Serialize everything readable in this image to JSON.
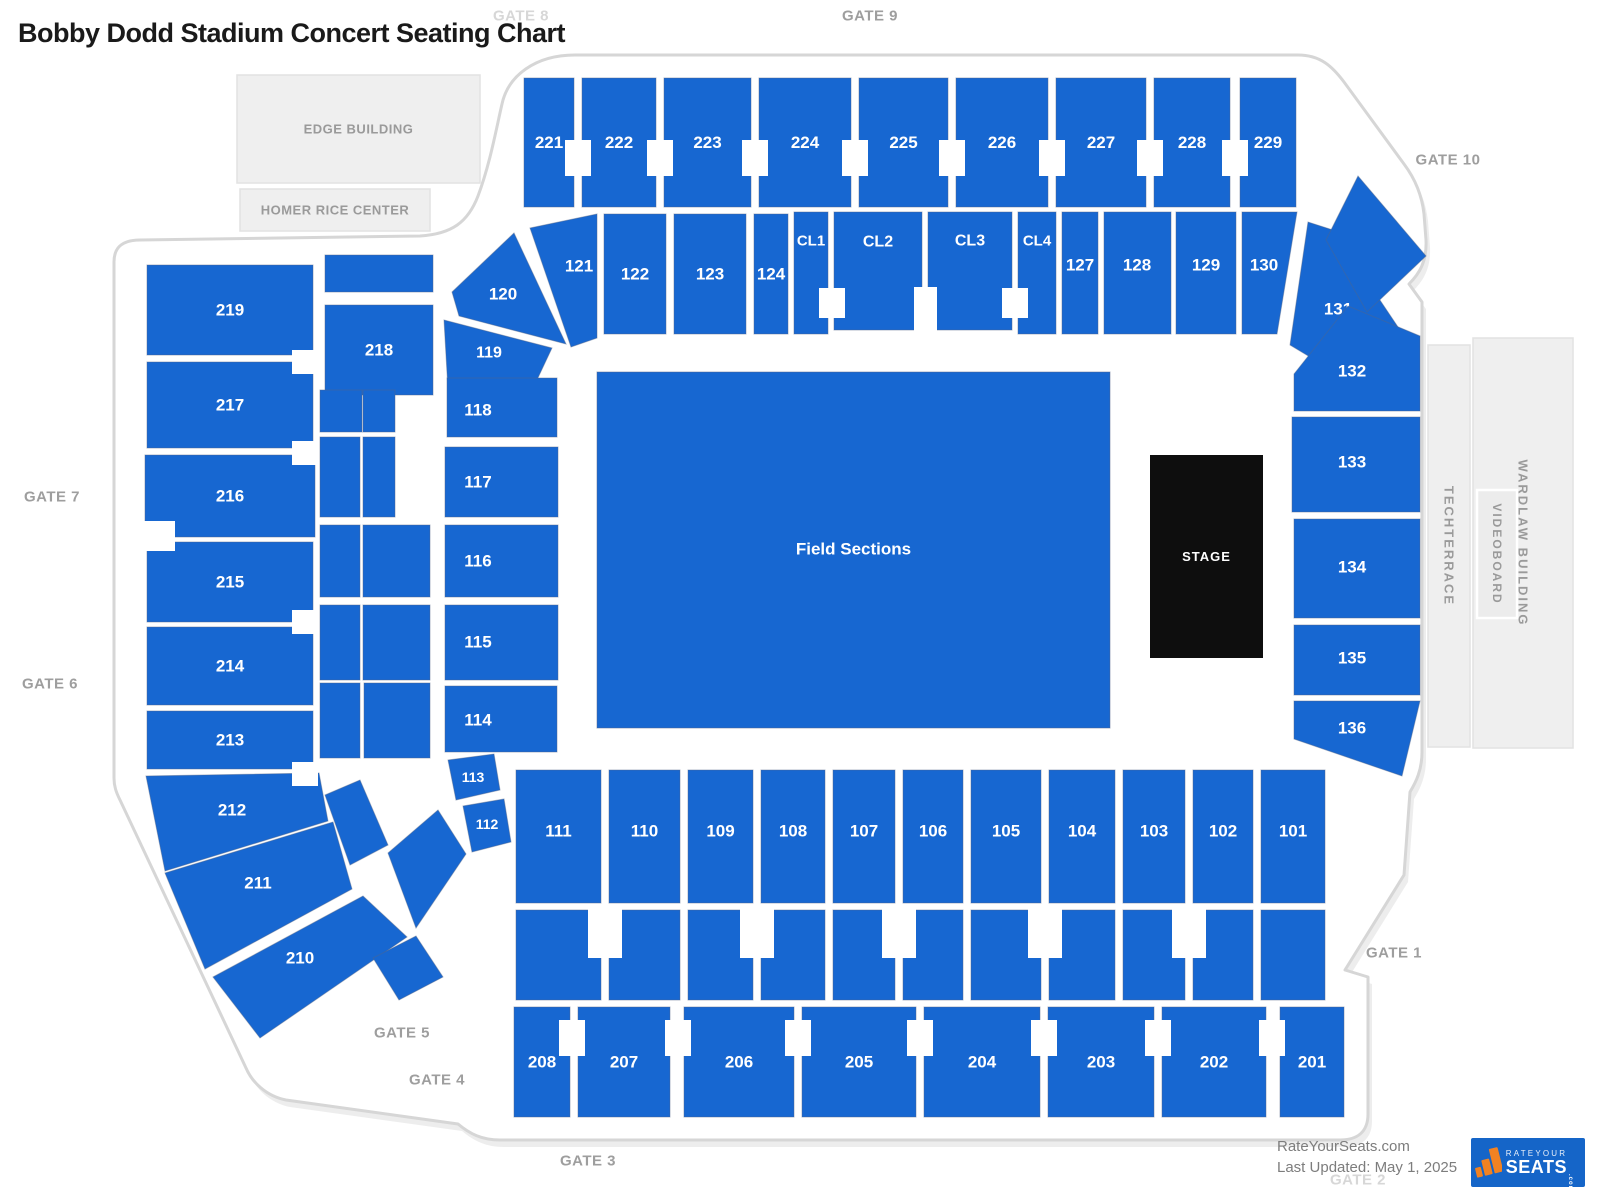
{
  "title": "Bobby Dodd Stadium Concert Seating Chart",
  "colors": {
    "section": "#1767D1",
    "section_stroke": "#51668A",
    "stage_bg": "#0E0E0E",
    "outline": "#D6D6D6",
    "building_fill": "#EFEFEF",
    "building_stroke": "#E2E2E2",
    "building_text": "#9A9A9A",
    "gate_text": "#9E9E9E",
    "gate_text_light": "#D7D7D7",
    "label_text": "#FFFFFF",
    "footer_text": "#7D7D7D",
    "logo_blue": "#1565C8",
    "logo_orange": "#F18222"
  },
  "gates": [
    {
      "id": "gate-8",
      "label": "GATE 8",
      "x": 521,
      "y": 16,
      "muted": true
    },
    {
      "id": "gate-9",
      "label": "GATE 9",
      "x": 870,
      "y": 16,
      "muted": false
    },
    {
      "id": "gate-10",
      "label": "GATE 10",
      "x": 1448,
      "y": 160,
      "muted": false
    },
    {
      "id": "gate-7",
      "label": "GATE 7",
      "x": 52,
      "y": 497,
      "muted": false
    },
    {
      "id": "gate-6",
      "label": "GATE 6",
      "x": 50,
      "y": 684,
      "muted": false
    },
    {
      "id": "gate-5",
      "label": "GATE 5",
      "x": 402,
      "y": 1033,
      "muted": false
    },
    {
      "id": "gate-4",
      "label": "GATE 4",
      "x": 437,
      "y": 1080,
      "muted": false
    },
    {
      "id": "gate-3",
      "label": "GATE 3",
      "x": 588,
      "y": 1161,
      "muted": false
    },
    {
      "id": "gate-2",
      "label": "GATE 2",
      "x": 1358,
      "y": 1180,
      "muted": true
    },
    {
      "id": "gate-1",
      "label": "GATE 1",
      "x": 1394,
      "y": 953,
      "muted": false
    }
  ],
  "buildings": [
    {
      "id": "edge-building",
      "label": "EDGE BUILDING",
      "x": 237,
      "y": 75,
      "w": 243,
      "h": 108,
      "vertical": false
    },
    {
      "id": "homer-rice-center",
      "label": "HOMER RICE CENTER",
      "x": 240,
      "y": 189,
      "w": 190,
      "h": 42,
      "vertical": false
    },
    {
      "id": "techterrace",
      "label": "TECHTERRACE",
      "x": 1428,
      "y": 345,
      "w": 42,
      "h": 402,
      "vertical": true
    },
    {
      "id": "wardlaw-building",
      "label": "WARDLAW BUILDING",
      "x": 1473,
      "y": 338,
      "w": 100,
      "h": 410,
      "vertical": true
    },
    {
      "id": "videoboard",
      "label": "VIDEOBOARD",
      "x": 1477,
      "y": 490,
      "w": 40,
      "h": 128,
      "vertical": true,
      "inner": true
    }
  ],
  "field": {
    "label": "Field Sections",
    "x": 597,
    "y": 372,
    "w": 513,
    "h": 356
  },
  "stage": {
    "label": "STAGE",
    "x": 1150,
    "y": 455,
    "w": 113,
    "h": 203
  },
  "sections": [
    {
      "id": "221",
      "label": "221",
      "r": [
        524,
        78,
        50,
        129
      ]
    },
    {
      "id": "222",
      "label": "222",
      "r": [
        582,
        78,
        74,
        129
      ]
    },
    {
      "id": "223",
      "label": "223",
      "r": [
        664,
        78,
        87,
        129
      ]
    },
    {
      "id": "224",
      "label": "224",
      "r": [
        759,
        78,
        92,
        129
      ]
    },
    {
      "id": "225",
      "label": "225",
      "r": [
        859,
        78,
        89,
        129
      ]
    },
    {
      "id": "226",
      "label": "226",
      "r": [
        956,
        78,
        92,
        129
      ]
    },
    {
      "id": "227",
      "label": "227",
      "r": [
        1056,
        78,
        90,
        129
      ]
    },
    {
      "id": "228",
      "label": "228",
      "r": [
        1154,
        78,
        76,
        129
      ]
    },
    {
      "id": "229",
      "label": "229",
      "r": [
        1240,
        78,
        56,
        129
      ]
    },
    {
      "id": "121",
      "label": "121",
      "p": [
        [
          530,
          228
        ],
        [
          597,
          214
        ],
        [
          597,
          338
        ],
        [
          571,
          347
        ]
      ],
      "lx": 579,
      "ly": 266
    },
    {
      "id": "122",
      "label": "122",
      "r": [
        604,
        214,
        62,
        120
      ]
    },
    {
      "id": "123",
      "label": "123",
      "r": [
        674,
        214,
        72,
        120
      ]
    },
    {
      "id": "124",
      "label": "124",
      "r": [
        754,
        214,
        34,
        120
      ]
    },
    {
      "id": "CL1",
      "label": "CL1",
      "r": [
        794,
        212,
        34,
        122
      ],
      "fs": 15,
      "lx": 811,
      "ly": 241
    },
    {
      "id": "CL2",
      "label": "CL2",
      "r": [
        834,
        212,
        88,
        118
      ],
      "fs": 16,
      "lx": 878,
      "ly": 242
    },
    {
      "id": "CL3",
      "label": "CL3",
      "r": [
        928,
        212,
        84,
        118
      ],
      "fs": 16,
      "lx": 970,
      "ly": 241
    },
    {
      "id": "CL4",
      "label": "CL4",
      "r": [
        1018,
        212,
        38,
        122
      ],
      "fs": 15,
      "lx": 1037,
      "ly": 241
    },
    {
      "id": "127",
      "label": "127",
      "r": [
        1062,
        212,
        36,
        122
      ],
      "lx": 1080,
      "ly": 265
    },
    {
      "id": "128",
      "label": "128",
      "r": [
        1104,
        212,
        67,
        122
      ],
      "lx": 1137,
      "ly": 265
    },
    {
      "id": "129",
      "label": "129",
      "r": [
        1176,
        212,
        60,
        122
      ],
      "lx": 1206,
      "ly": 265
    },
    {
      "id": "130",
      "label": "130",
      "p": [
        [
          1242,
          212
        ],
        [
          1297,
          212
        ],
        [
          1277,
          334
        ],
        [
          1242,
          334
        ]
      ],
      "lx": 1264,
      "ly": 265
    },
    {
      "id": "131",
      "label": "131",
      "p": [
        [
          1290,
          345
        ],
        [
          1308,
          222
        ],
        [
          1333,
          230
        ],
        [
          1400,
          330
        ],
        [
          1345,
          378
        ]
      ],
      "lx": 1338,
      "ly": 309
    },
    {
      "id": "corner-ne",
      "label": "",
      "p": [
        [
          1326,
          240
        ],
        [
          1358,
          176
        ],
        [
          1426,
          256
        ],
        [
          1367,
          312
        ]
      ]
    },
    {
      "id": "120",
      "label": "120",
      "p": [
        [
          452,
          292
        ],
        [
          514,
          233
        ],
        [
          566,
          344
        ],
        [
          459,
          316
        ]
      ],
      "lx": 503,
      "ly": 294
    },
    {
      "id": "119",
      "label": "119",
      "p": [
        [
          444,
          320
        ],
        [
          552,
          348
        ],
        [
          536,
          382
        ],
        [
          448,
          390
        ]
      ],
      "lx": 489,
      "ly": 353,
      "fs": 16
    },
    {
      "id": "219",
      "label": "219",
      "r": [
        147,
        265,
        166,
        90
      ]
    },
    {
      "id": "strip-218-upper",
      "label": "",
      "r": [
        325,
        255,
        108,
        37
      ]
    },
    {
      "id": "218",
      "label": "218",
      "r": [
        325,
        305,
        108,
        90
      ]
    },
    {
      "id": "217",
      "label": "217",
      "r": [
        147,
        362,
        166,
        86
      ]
    },
    {
      "id": "216",
      "label": "216",
      "r": [
        145,
        455,
        170,
        82
      ]
    },
    {
      "id": "215",
      "label": "215",
      "r": [
        147,
        542,
        166,
        80
      ]
    },
    {
      "id": "214",
      "label": "214",
      "r": [
        147,
        627,
        166,
        78
      ]
    },
    {
      "id": "213",
      "label": "213",
      "r": [
        147,
        711,
        166,
        58
      ]
    },
    {
      "id": "212",
      "label": "212",
      "p": [
        [
          146,
          776
        ],
        [
          319,
          773
        ],
        [
          328,
          821
        ],
        [
          165,
          871
        ]
      ],
      "lx": 232,
      "ly": 810
    },
    {
      "id": "211",
      "label": "211",
      "p": [
        [
          165,
          873
        ],
        [
          333,
          822
        ],
        [
          352,
          889
        ],
        [
          205,
          969
        ]
      ],
      "lx": 258,
      "ly": 883
    },
    {
      "id": "210",
      "label": "210",
      "p": [
        [
          213,
          977
        ],
        [
          363,
          896
        ],
        [
          407,
          937
        ],
        [
          260,
          1038
        ]
      ],
      "lx": 300,
      "ly": 958
    },
    {
      "id": "strip-1",
      "label": "",
      "r": [
        320,
        390,
        42,
        42
      ]
    },
    {
      "id": "strip-2",
      "label": "",
      "r": [
        363,
        390,
        32,
        42
      ]
    },
    {
      "id": "strip-3",
      "label": "",
      "r": [
        320,
        437,
        40,
        80
      ]
    },
    {
      "id": "strip-4",
      "label": "",
      "r": [
        363,
        437,
        32,
        80
      ]
    },
    {
      "id": "strip-5",
      "label": "",
      "r": [
        320,
        525,
        40,
        72
      ]
    },
    {
      "id": "strip-6",
      "label": "",
      "r": [
        363,
        525,
        67,
        72
      ]
    },
    {
      "id": "strip-7",
      "label": "",
      "r": [
        320,
        605,
        40,
        75
      ]
    },
    {
      "id": "strip-8",
      "label": "",
      "r": [
        363,
        605,
        67,
        75
      ]
    },
    {
      "id": "strip-9",
      "label": "",
      "r": [
        320,
        683,
        40,
        75
      ]
    },
    {
      "id": "strip-10",
      "label": "",
      "r": [
        364,
        683,
        66,
        75
      ]
    },
    {
      "id": "strip-11",
      "label": "",
      "p": [
        [
          325,
          795
        ],
        [
          360,
          780
        ],
        [
          388,
          845
        ],
        [
          350,
          865
        ]
      ]
    },
    {
      "id": "strip-12",
      "label": "",
      "p": [
        [
          388,
          853
        ],
        [
          438,
          810
        ],
        [
          466,
          854
        ],
        [
          416,
          928
        ]
      ]
    },
    {
      "id": "strip-13",
      "label": "",
      "p": [
        [
          373,
          958
        ],
        [
          416,
          936
        ],
        [
          443,
          977
        ],
        [
          399,
          1000
        ]
      ]
    },
    {
      "id": "118",
      "label": "118",
      "r": [
        447,
        378,
        110,
        59
      ],
      "lx": 478,
      "ly": 410
    },
    {
      "id": "117",
      "label": "117",
      "r": [
        445,
        447,
        113,
        70
      ],
      "lx": 478,
      "ly": 482
    },
    {
      "id": "116",
      "label": "116",
      "r": [
        445,
        525,
        113,
        72
      ],
      "lx": 478,
      "ly": 561
    },
    {
      "id": "115",
      "label": "115",
      "r": [
        445,
        605,
        113,
        75
      ],
      "lx": 478,
      "ly": 642
    },
    {
      "id": "114",
      "label": "114",
      "r": [
        445,
        686,
        112,
        66
      ],
      "lx": 478,
      "ly": 720
    },
    {
      "id": "113",
      "label": "113",
      "p": [
        [
          448,
          760
        ],
        [
          494,
          754
        ],
        [
          500,
          790
        ],
        [
          456,
          800
        ]
      ],
      "lx": 473,
      "ly": 777,
      "fs": 14
    },
    {
      "id": "112",
      "label": "112",
      "p": [
        [
          463,
          806
        ],
        [
          504,
          799
        ],
        [
          511,
          842
        ],
        [
          472,
          852
        ]
      ],
      "lx": 487,
      "ly": 824,
      "fs": 14
    },
    {
      "id": "132",
      "label": "132",
      "p": [
        [
          1294,
          374
        ],
        [
          1348,
          306
        ],
        [
          1420,
          336
        ],
        [
          1420,
          411
        ],
        [
          1294,
          411
        ]
      ],
      "lx": 1352,
      "ly": 371
    },
    {
      "id": "133",
      "label": "133",
      "r": [
        1292,
        417,
        128,
        95
      ],
      "lx": 1352,
      "ly": 462
    },
    {
      "id": "134",
      "label": "134",
      "r": [
        1294,
        519,
        126,
        99
      ],
      "lx": 1352,
      "ly": 567
    },
    {
      "id": "135",
      "label": "135",
      "r": [
        1294,
        625,
        126,
        70
      ],
      "lx": 1352,
      "ly": 658
    },
    {
      "id": "136",
      "label": "136",
      "p": [
        [
          1294,
          701
        ],
        [
          1420,
          701
        ],
        [
          1402,
          776
        ],
        [
          1294,
          739
        ]
      ],
      "lx": 1352,
      "ly": 728
    },
    {
      "id": "111",
      "label": "111",
      "r": [
        516,
        770,
        85,
        133
      ],
      "ly": 831
    },
    {
      "id": "110",
      "label": "110",
      "r": [
        609,
        770,
        71,
        133
      ],
      "ly": 831
    },
    {
      "id": "109",
      "label": "109",
      "r": [
        688,
        770,
        65,
        133
      ],
      "ly": 831
    },
    {
      "id": "108",
      "label": "108",
      "r": [
        761,
        770,
        64,
        133
      ],
      "ly": 831
    },
    {
      "id": "107",
      "label": "107",
      "r": [
        833,
        770,
        62,
        133
      ],
      "ly": 831
    },
    {
      "id": "106",
      "label": "106",
      "r": [
        903,
        770,
        60,
        133
      ],
      "ly": 831
    },
    {
      "id": "105",
      "label": "105",
      "r": [
        971,
        770,
        70,
        133
      ],
      "ly": 831
    },
    {
      "id": "104",
      "label": "104",
      "r": [
        1049,
        770,
        66,
        133
      ],
      "ly": 831
    },
    {
      "id": "103",
      "label": "103",
      "r": [
        1123,
        770,
        62,
        133
      ],
      "ly": 831
    },
    {
      "id": "102",
      "label": "102",
      "r": [
        1193,
        770,
        60,
        133
      ],
      "ly": 831
    },
    {
      "id": "101",
      "label": "101",
      "r": [
        1261,
        770,
        64,
        133
      ],
      "ly": 831
    },
    {
      "id": "band-111",
      "label": "",
      "r": [
        516,
        910,
        85,
        90
      ]
    },
    {
      "id": "band-110",
      "label": "",
      "r": [
        609,
        910,
        71,
        90
      ]
    },
    {
      "id": "band-109",
      "label": "",
      "r": [
        688,
        910,
        65,
        90
      ]
    },
    {
      "id": "band-108",
      "label": "",
      "r": [
        761,
        910,
        64,
        90
      ]
    },
    {
      "id": "band-107",
      "label": "",
      "r": [
        833,
        910,
        62,
        90
      ]
    },
    {
      "id": "band-106",
      "label": "",
      "r": [
        903,
        910,
        60,
        90
      ]
    },
    {
      "id": "band-105",
      "label": "",
      "r": [
        971,
        910,
        70,
        90
      ]
    },
    {
      "id": "band-104",
      "label": "",
      "r": [
        1049,
        910,
        66,
        90
      ]
    },
    {
      "id": "band-103",
      "label": "",
      "r": [
        1123,
        910,
        62,
        90
      ]
    },
    {
      "id": "band-102",
      "label": "",
      "r": [
        1193,
        910,
        60,
        90
      ]
    },
    {
      "id": "band-101",
      "label": "",
      "r": [
        1261,
        910,
        64,
        90
      ]
    },
    {
      "id": "208",
      "label": "208",
      "r": [
        514,
        1007,
        56,
        110
      ],
      "ly": 1062
    },
    {
      "id": "207",
      "label": "207",
      "r": [
        578,
        1007,
        92,
        110
      ],
      "ly": 1062
    },
    {
      "id": "206",
      "label": "206",
      "r": [
        684,
        1007,
        110,
        110
      ],
      "ly": 1062
    },
    {
      "id": "205",
      "label": "205",
      "r": [
        802,
        1007,
        114,
        110
      ],
      "ly": 1062
    },
    {
      "id": "204",
      "label": "204",
      "r": [
        924,
        1007,
        116,
        110
      ],
      "ly": 1062
    },
    {
      "id": "203",
      "label": "203",
      "r": [
        1048,
        1007,
        106,
        110
      ],
      "ly": 1062
    },
    {
      "id": "202",
      "label": "202",
      "r": [
        1162,
        1007,
        104,
        110
      ],
      "ly": 1062
    },
    {
      "id": "201",
      "label": "201",
      "r": [
        1280,
        1007,
        64,
        110
      ],
      "ly": 1062
    }
  ],
  "footer": {
    "site": "RateYourSeats.com",
    "updated": "Last Updated: May 1, 2025",
    "logo": {
      "brand_top": "RATEYOUR",
      "brand_main": "SEATS",
      "brand_suffix": ".com"
    }
  }
}
